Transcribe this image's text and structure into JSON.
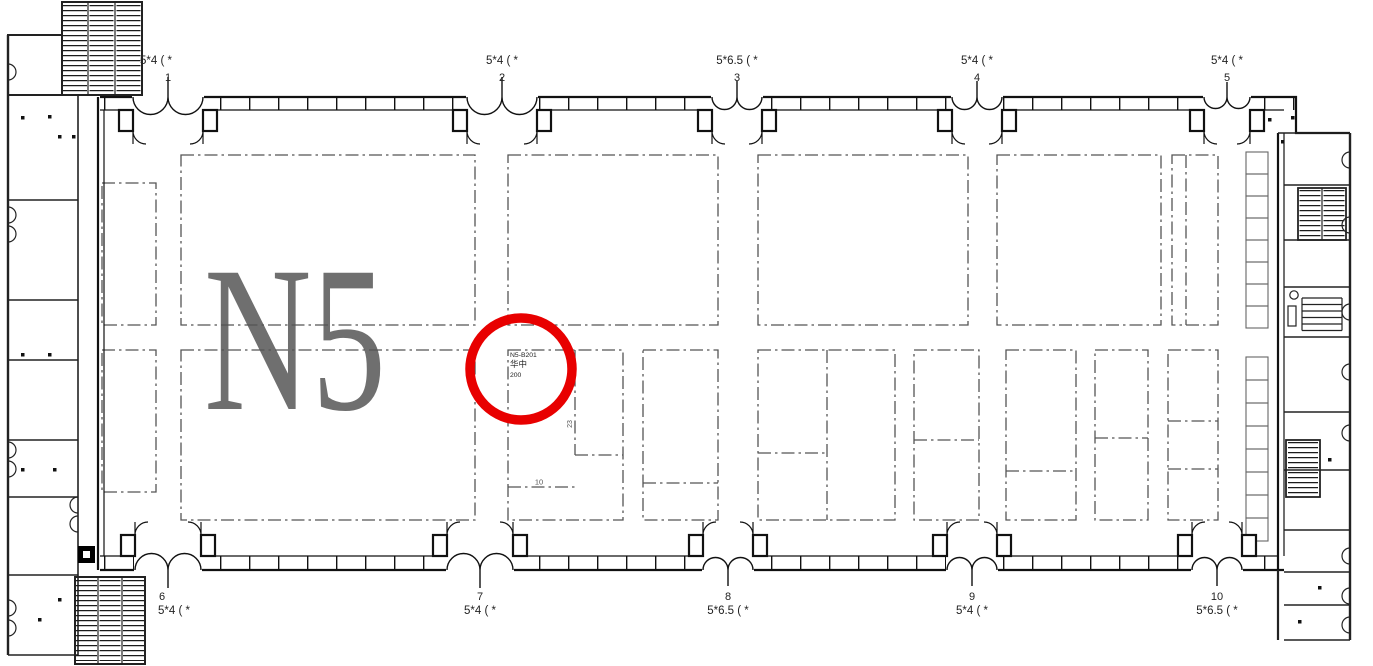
{
  "hall": {
    "name": "N5"
  },
  "highlight": {
    "booth_id": "N5-B201",
    "booth_name": "华中",
    "booth_size": "200"
  },
  "top_doors": [
    {
      "num": "1",
      "size": "5*4  (  *"
    },
    {
      "num": "2",
      "size": "5*4  (  *"
    },
    {
      "num": "3",
      "size": "5*6.5  (  *"
    },
    {
      "num": "4",
      "size": "5*4  (  *"
    },
    {
      "num": "5",
      "size": "5*4  (  *"
    }
  ],
  "bottom_doors": [
    {
      "num": "6",
      "size": "5*4  (  *"
    },
    {
      "num": "7",
      "size": "5*4  (  *"
    },
    {
      "num": "8",
      "size": "5*6.5  (  *"
    },
    {
      "num": "9",
      "size": "5*4  (  *"
    },
    {
      "num": "10",
      "size": "5*6.5  (  *"
    }
  ],
  "dimensions": {
    "width_label": "10",
    "depth_label": "23"
  },
  "colors": {
    "accent_red": "#e80000",
    "plan_gray": "#555555",
    "hall_label_gray": "#6f6f6f"
  }
}
